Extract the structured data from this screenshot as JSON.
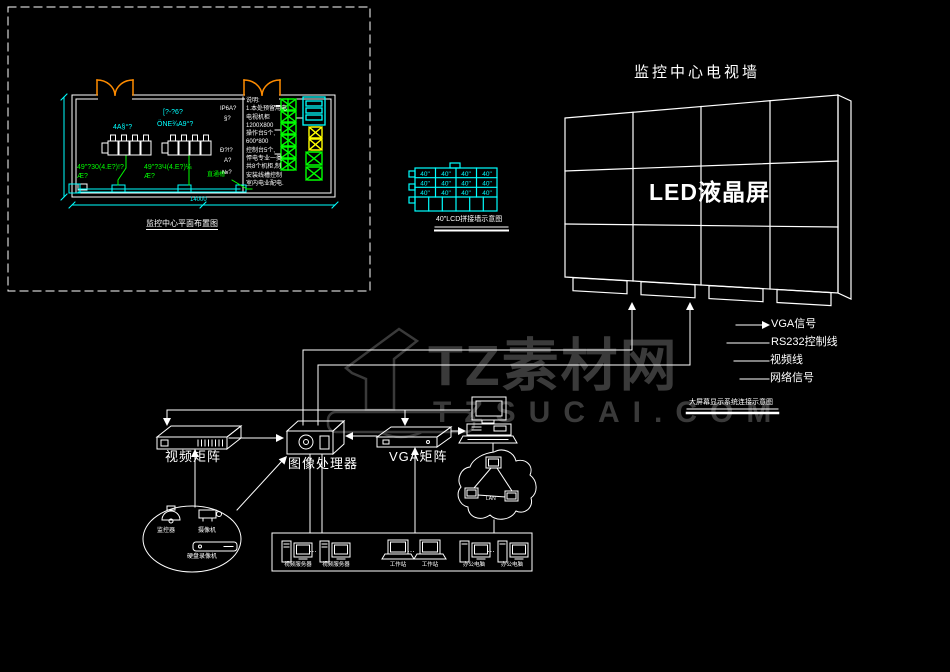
{
  "watermark": {
    "numeral": "1",
    "brand": "TZ素材网",
    "domain": "TZSUCAI.COM"
  },
  "tv_wall": {
    "title": "监控中心电视墙",
    "label": "LED液晶屏"
  },
  "legend": {
    "items": [
      "VGA信号",
      "RS232控制线",
      "视频线",
      "网络信号"
    ],
    "caption": "大屏幕显示系统连接示意图"
  },
  "devices": {
    "video_matrix": "视频矩阵",
    "image_processor": "图像处理器",
    "vga_matrix": "VGA矩阵"
  },
  "sources": {
    "dome_camera": "监控器",
    "box_camera": "摄像机",
    "dvr": "硬盘录像机"
  },
  "cloud": {
    "label": "LAN"
  },
  "terminals": {
    "labels": [
      "视频服务器",
      "视频服务器",
      "工作站",
      "工作站",
      "办公电脑",
      "办公电脑"
    ],
    "separator": "…"
  },
  "floor_plan": {
    "caption": "监控中心平面布置图",
    "console_label_1": "4A§°?",
    "console_label_2a": "[?-?6?",
    "console_label_2b": "ÖNE¾A9°?",
    "cable_text_1a": "49\"?30(4.E?)!?",
    "cable_text_1b": "Æ?",
    "cable_text_2a": "49\"?3Ч(4.E?)¼",
    "cable_text_2b": "Æ?",
    "duct_label": "直通槽",
    "side_notes": [
      "IP6A?",
      "§?",
      "Ð?!?",
      "A?",
      "№?"
    ],
    "notes": [
      "说明:",
      "1.本处预留用电",
      "电视机柜",
      "1200X800",
      "操作台5个,",
      "600*800",
      "控制台5个,",
      "悍电专业一类",
      "共8个机柜,制",
      "安装线槽控制",
      "室内电业配电."
    ],
    "dim_bottom": "14000"
  },
  "elevation": {
    "cell": "40\"",
    "caption": "40\"LCD拼接墙示意图"
  }
}
